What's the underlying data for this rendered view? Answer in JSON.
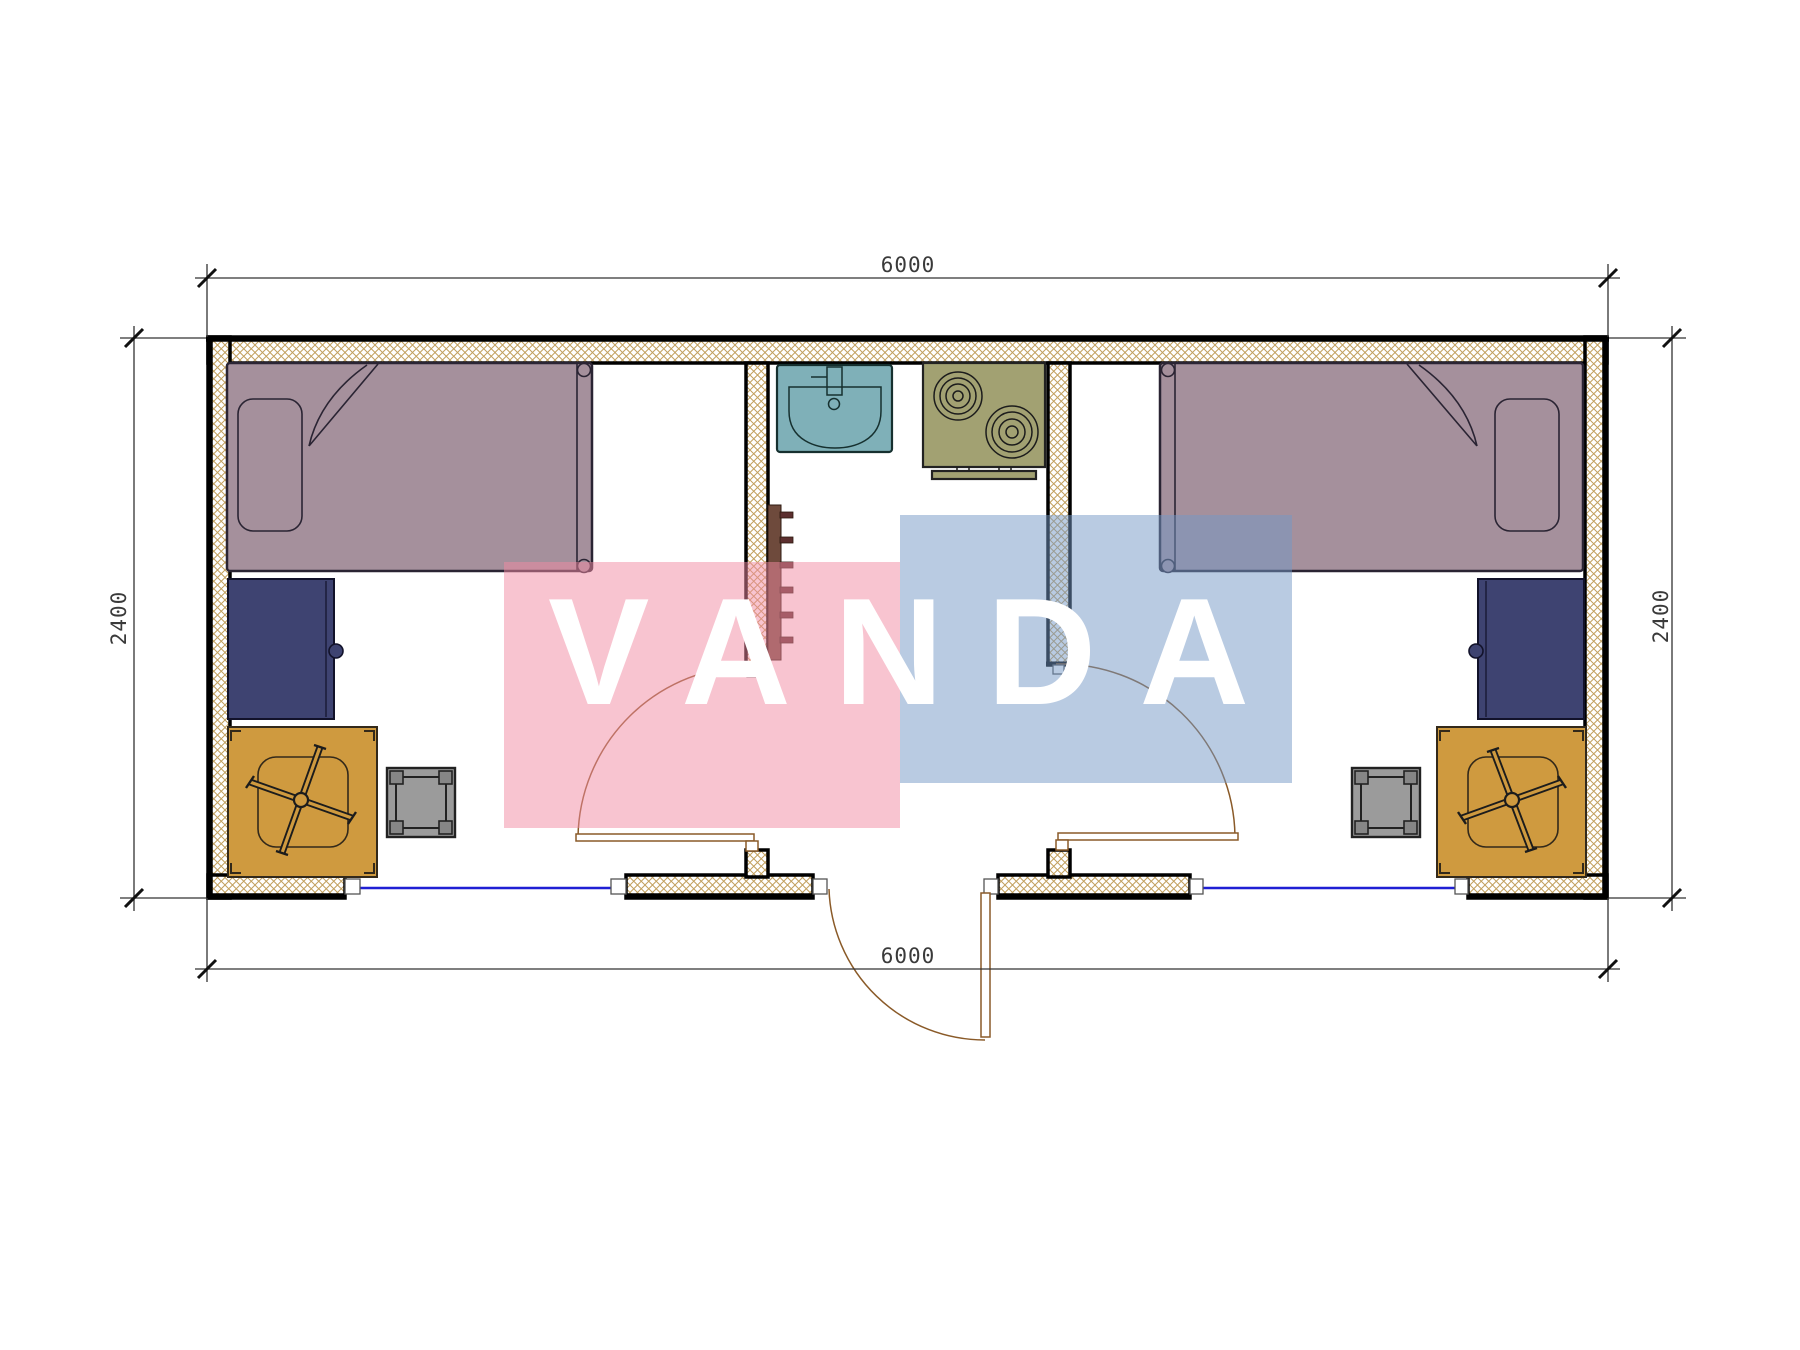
{
  "watermark": {
    "text": "VANDA"
  },
  "dimensions": {
    "top_mm": "6000",
    "bottom_mm": "6000",
    "left_mm": "2400",
    "right_mm": "2400"
  },
  "plan": {
    "type": "container-house-floor-plan",
    "overall_width_mm": 6000,
    "overall_depth_mm": 2400,
    "rooms": [
      {
        "name": "left-bedroom",
        "furniture": [
          "single-bed",
          "pillow",
          "desk",
          "swivel-chair",
          "stool"
        ]
      },
      {
        "name": "kitchen",
        "furniture": [
          "sink",
          "two-burner-stove",
          "wall-ladder-rack"
        ]
      },
      {
        "name": "right-bedroom",
        "furniture": [
          "single-bed",
          "pillow",
          "desk",
          "swivel-chair",
          "stool"
        ]
      }
    ],
    "openings": [
      "left-bedroom-door",
      "entry-door",
      "right-bedroom-door",
      "left-window",
      "right-window"
    ]
  },
  "colors": {
    "outline": "#000000",
    "hatch": "#c2a05e",
    "bed": "#a5909c",
    "bedLine": "#2a2433",
    "desk": "#3e4371",
    "chair": "#cf9a3f",
    "stool": "#9b9b9b",
    "sink": "#7fb0b8",
    "stove": "#a2a172",
    "ladder": "#6e4a3c",
    "rung": "#5c2f2f",
    "window": "#1f1fd4",
    "door": "#8a5a28",
    "dim": "#333333",
    "wmPink": "#f189a1",
    "wmBlue": "#7397c5",
    "wmText": "#ffffff"
  }
}
